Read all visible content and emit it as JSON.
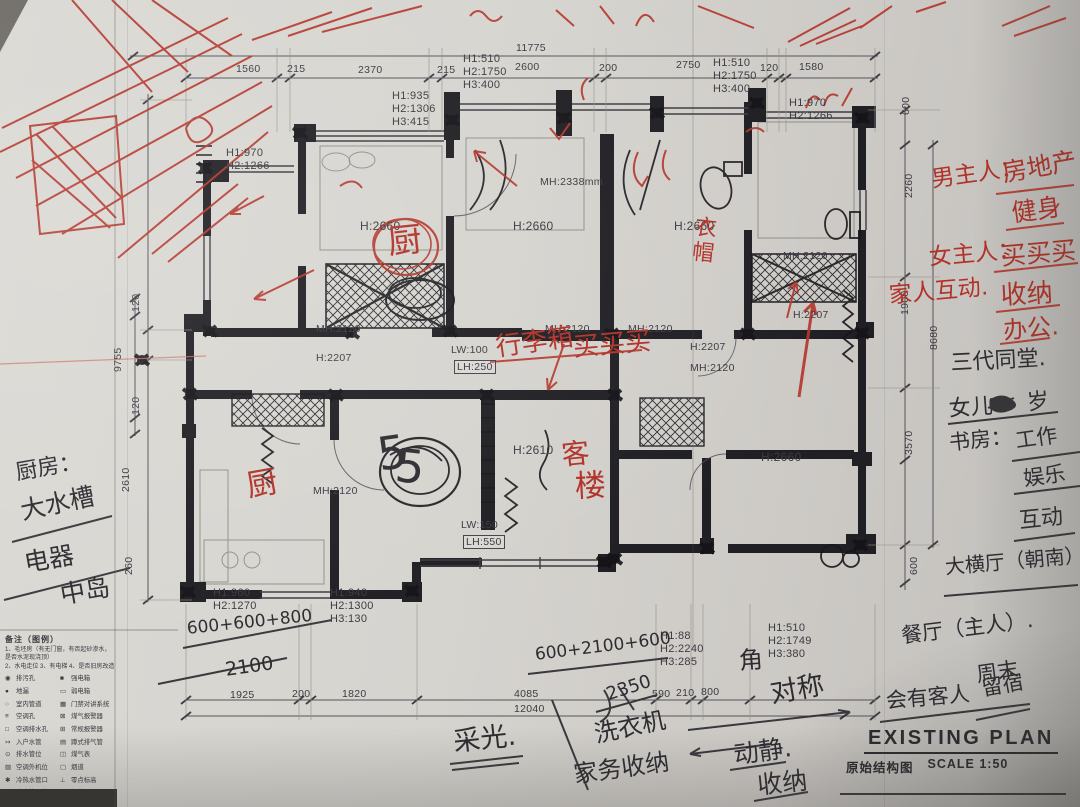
{
  "title_block": {
    "title_en": "EXISTING PLAN",
    "title_cn": "原始结构图",
    "scale": "SCALE 1:50"
  },
  "legend": {
    "heading": "备注（图例）",
    "notes": [
      "1、毛坯房（有无门窗，有否起砂渗水，是否水泥现浇顶）",
      "2、水电走位 3、有电梯 4、是否旧房改造"
    ],
    "left": [
      [
        "◉",
        "排污孔"
      ],
      [
        "●",
        "地漏"
      ],
      [
        "○",
        "室内管道"
      ],
      [
        "≡",
        "空调孔"
      ],
      [
        "□",
        "空调排水孔"
      ],
      [
        "↣",
        "入户水管"
      ],
      [
        "⊙",
        "排水管位"
      ],
      [
        "▨",
        "空调外机位"
      ],
      [
        "✱",
        "冷热水管口"
      ],
      [
        "∗",
        "冷水管口位"
      ],
      [
        "·",
        "热水管口位"
      ]
    ],
    "right": [
      [
        "■",
        "强电箱"
      ],
      [
        "▭",
        "弱电箱"
      ],
      [
        "▦",
        "门禁对讲系统"
      ],
      [
        "⊠",
        "煤气报警器"
      ],
      [
        "⊞",
        "常规报警器"
      ],
      [
        "▤",
        "蹲式排气管"
      ],
      [
        "◫",
        "煤气表"
      ],
      [
        "▢",
        "烟道"
      ],
      [
        "⊥",
        "零点标高"
      ],
      [
        "═",
        "梁位"
      ],
      [
        "▬",
        "窗位"
      ]
    ]
  },
  "printed_labels": [
    {
      "t": "11775",
      "x": 516,
      "y": 42
    },
    {
      "t": "1560",
      "x": 236,
      "y": 63
    },
    {
      "t": "215",
      "x": 287,
      "y": 63
    },
    {
      "t": "2370",
      "x": 358,
      "y": 64
    },
    {
      "t": "215",
      "x": 437,
      "y": 64
    },
    {
      "t": "H1:510\nH2:1750\nH3:400",
      "x": 463,
      "y": 53,
      "s": 11
    },
    {
      "t": "2600",
      "x": 515,
      "y": 61
    },
    {
      "t": "200",
      "x": 599,
      "y": 62
    },
    {
      "t": "2750",
      "x": 676,
      "y": 59
    },
    {
      "t": "H1:510\nH2:1750\nH3:400",
      "x": 713,
      "y": 57,
      "s": 11
    },
    {
      "t": "120",
      "x": 760,
      "y": 62
    },
    {
      "t": "1580",
      "x": 799,
      "y": 61
    },
    {
      "t": "H1:935\nH2:1306\nH3:415",
      "x": 392,
      "y": 90,
      "s": 11
    },
    {
      "t": "H1:970\nH2:1266",
      "x": 789,
      "y": 97,
      "s": 11
    },
    {
      "t": "H1:970\nH2:1266",
      "x": 226,
      "y": 147,
      "s": 11
    },
    {
      "t": "MH:2338mm",
      "x": 540,
      "y": 176
    },
    {
      "t": "H:2660",
      "x": 360,
      "y": 219,
      "s": 12
    },
    {
      "t": "H:2660",
      "x": 513,
      "y": 219,
      "s": 12
    },
    {
      "t": "H:2660",
      "x": 674,
      "y": 219,
      "s": 12
    },
    {
      "t": "MH:2120",
      "x": 316,
      "y": 323
    },
    {
      "t": "MH:2120",
      "x": 545,
      "y": 323
    },
    {
      "t": "MH:2120",
      "x": 628,
      "y": 323
    },
    {
      "t": "H:2207",
      "x": 316,
      "y": 352
    },
    {
      "t": "LW:100",
      "x": 451,
      "y": 344
    },
    {
      "t": "LH:250",
      "x": 455,
      "y": 361,
      "b": true
    },
    {
      "t": "H:2207",
      "x": 690,
      "y": 341
    },
    {
      "t": "MH:2120",
      "x": 690,
      "y": 362
    },
    {
      "t": "MH:2120",
      "x": 783,
      "y": 250
    },
    {
      "t": "H:2207",
      "x": 793,
      "y": 309
    },
    {
      "t": "H:2610",
      "x": 513,
      "y": 443,
      "s": 12
    },
    {
      "t": "H:2660",
      "x": 761,
      "y": 450,
      "s": 12
    },
    {
      "t": "MH:2120",
      "x": 313,
      "y": 485
    },
    {
      "t": "LW:150",
      "x": 461,
      "y": 519
    },
    {
      "t": "LH:550",
      "x": 464,
      "y": 536,
      "b": true
    },
    {
      "t": "H1:960\nH2:1270",
      "x": 213,
      "y": 587,
      "s": 11
    },
    {
      "t": "H1:940\nH2:1300\nH3:130",
      "x": 330,
      "y": 587,
      "s": 11
    },
    {
      "t": "H1:88\nH2:2240\nH3:285",
      "x": 660,
      "y": 630,
      "s": 11
    },
    {
      "t": "H1:510\nH2:1749\nH3:380",
      "x": 768,
      "y": 622,
      "s": 11
    },
    {
      "t": "1925",
      "x": 230,
      "y": 689
    },
    {
      "t": "200",
      "x": 292,
      "y": 688
    },
    {
      "t": "1820",
      "x": 342,
      "y": 688
    },
    {
      "t": "4085",
      "x": 514,
      "y": 688
    },
    {
      "t": "12040",
      "x": 514,
      "y": 703
    },
    {
      "t": "590",
      "x": 652,
      "y": 688
    },
    {
      "t": "210",
      "x": 676,
      "y": 687
    },
    {
      "t": "800",
      "x": 701,
      "y": 686
    },
    {
      "t": "9755",
      "x": 112,
      "y": 372,
      "r": -90
    },
    {
      "t": "120",
      "x": 130,
      "y": 312,
      "r": -90
    },
    {
      "t": "120",
      "x": 130,
      "y": 415,
      "r": -90
    },
    {
      "t": "2610",
      "x": 120,
      "y": 492,
      "r": -90
    },
    {
      "t": "260",
      "x": 123,
      "y": 575,
      "r": -90
    },
    {
      "t": "600",
      "x": 900,
      "y": 115,
      "r": -90
    },
    {
      "t": "2260",
      "x": 903,
      "y": 198,
      "r": -90
    },
    {
      "t": "1900",
      "x": 899,
      "y": 315,
      "r": -90
    },
    {
      "t": "8680",
      "x": 928,
      "y": 350,
      "r": -90
    },
    {
      "t": "3570",
      "x": 903,
      "y": 455,
      "r": -90
    },
    {
      "t": "600",
      "x": 908,
      "y": 575,
      "r": -90
    }
  ],
  "notes_black": [
    {
      "t": "厨房：",
      "x": 14,
      "y": 462,
      "s": 22,
      "r": -10
    },
    {
      "t": "大水槽",
      "x": 18,
      "y": 498,
      "s": 25,
      "r": -12
    },
    {
      "t": "电器",
      "x": 22,
      "y": 550,
      "s": 25,
      "r": -10
    },
    {
      "t": "中岛",
      "x": 58,
      "y": 582,
      "s": 25,
      "r": -10
    },
    {
      "t": "三代同堂.",
      "x": 950,
      "y": 352,
      "s": 22,
      "r": -3
    },
    {
      "t": "女儿",
      "x": 948,
      "y": 398,
      "s": 22,
      "r": -4
    },
    {
      "t": "岁",
      "x": 1026,
      "y": 392,
      "s": 22,
      "r": -6
    },
    {
      "t": "书房：",
      "x": 948,
      "y": 432,
      "s": 21,
      "r": -6
    },
    {
      "t": "工作",
      "x": 1014,
      "y": 430,
      "s": 21,
      "r": -8
    },
    {
      "t": "娱乐",
      "x": 1022,
      "y": 468,
      "s": 21,
      "r": -8
    },
    {
      "t": "互动",
      "x": 1018,
      "y": 510,
      "s": 22,
      "r": -6
    },
    {
      "t": "大横厅（朝南）",
      "x": 944,
      "y": 556,
      "s": 20,
      "r": -5
    },
    {
      "t": "餐厅（主人）.",
      "x": 900,
      "y": 625,
      "s": 21,
      "r": -7
    },
    {
      "t": "周末",
      "x": 975,
      "y": 664,
      "s": 21,
      "r": -8
    },
    {
      "t": "会有客人",
      "x": 885,
      "y": 690,
      "s": 21,
      "r": -5
    },
    {
      "t": "留宿",
      "x": 980,
      "y": 678,
      "s": 21,
      "r": -10
    },
    {
      "t": "采光.",
      "x": 452,
      "y": 728,
      "s": 27,
      "r": -6
    },
    {
      "t": "洗衣机",
      "x": 592,
      "y": 722,
      "s": 24,
      "r": -12
    },
    {
      "t": "家务收纳",
      "x": 572,
      "y": 762,
      "s": 24,
      "r": -8
    },
    {
      "t": "动静.",
      "x": 732,
      "y": 742,
      "s": 25,
      "r": -8
    },
    {
      "t": "收纳",
      "x": 756,
      "y": 772,
      "s": 25,
      "r": -6
    },
    {
      "t": "角",
      "x": 738,
      "y": 648,
      "s": 24,
      "r": -4
    },
    {
      "t": "对称",
      "x": 768,
      "y": 680,
      "s": 27,
      "r": -10
    },
    {
      "t": "600+2100+600",
      "x": 534,
      "y": 646,
      "s": 17,
      "r": -7
    },
    {
      "t": "600+600+800",
      "x": 186,
      "y": 620,
      "s": 17,
      "r": -6
    },
    {
      "t": "2100",
      "x": 224,
      "y": 660,
      "s": 19,
      "r": -8
    },
    {
      "t": "2350",
      "x": 604,
      "y": 686,
      "s": 18,
      "r": -18
    },
    {
      "t": "5",
      "x": 374,
      "y": 430,
      "s": 46,
      "r": -8
    },
    {
      "t": "5",
      "x": 398,
      "y": 440,
      "s": 46,
      "r": 6
    }
  ],
  "notes_red": [
    {
      "t": "男主人：",
      "x": 930,
      "y": 168,
      "s": 23,
      "r": -8
    },
    {
      "t": "房地产",
      "x": 1000,
      "y": 160,
      "s": 25,
      "r": -10
    },
    {
      "t": "健身",
      "x": 1010,
      "y": 200,
      "s": 25,
      "r": -8
    },
    {
      "t": "女主人：",
      "x": 928,
      "y": 246,
      "s": 23,
      "r": -5
    },
    {
      "t": "买买买",
      "x": 1000,
      "y": 243,
      "s": 25,
      "r": -5
    },
    {
      "t": "家人互动.",
      "x": 888,
      "y": 284,
      "s": 23,
      "r": -5
    },
    {
      "t": "收纳",
      "x": 1000,
      "y": 282,
      "s": 26,
      "r": -3
    },
    {
      "t": "办公.",
      "x": 1002,
      "y": 318,
      "s": 24,
      "r": -5
    },
    {
      "t": "行李箱",
      "x": 494,
      "y": 334,
      "s": 26,
      "r": -8
    },
    {
      "t": "买买买",
      "x": 572,
      "y": 334,
      "s": 26,
      "r": -5
    },
    {
      "t": "厨",
      "x": 386,
      "y": 224,
      "s": 34,
      "r": -6
    },
    {
      "t": "衣\n帽",
      "x": 696,
      "y": 216,
      "s": 22,
      "r": 6
    },
    {
      "t": "厨",
      "x": 244,
      "y": 470,
      "s": 31,
      "r": -10
    },
    {
      "t": "客",
      "x": 560,
      "y": 440,
      "s": 28,
      "r": -6
    },
    {
      "t": "楼",
      "x": 574,
      "y": 470,
      "s": 31,
      "r": -3
    }
  ],
  "colors": {
    "paper": "#d6d4cf",
    "ink": "#1b1b20",
    "print": "#3c3c42",
    "red_pen": "#b5372c",
    "pencil": "#97958d"
  }
}
